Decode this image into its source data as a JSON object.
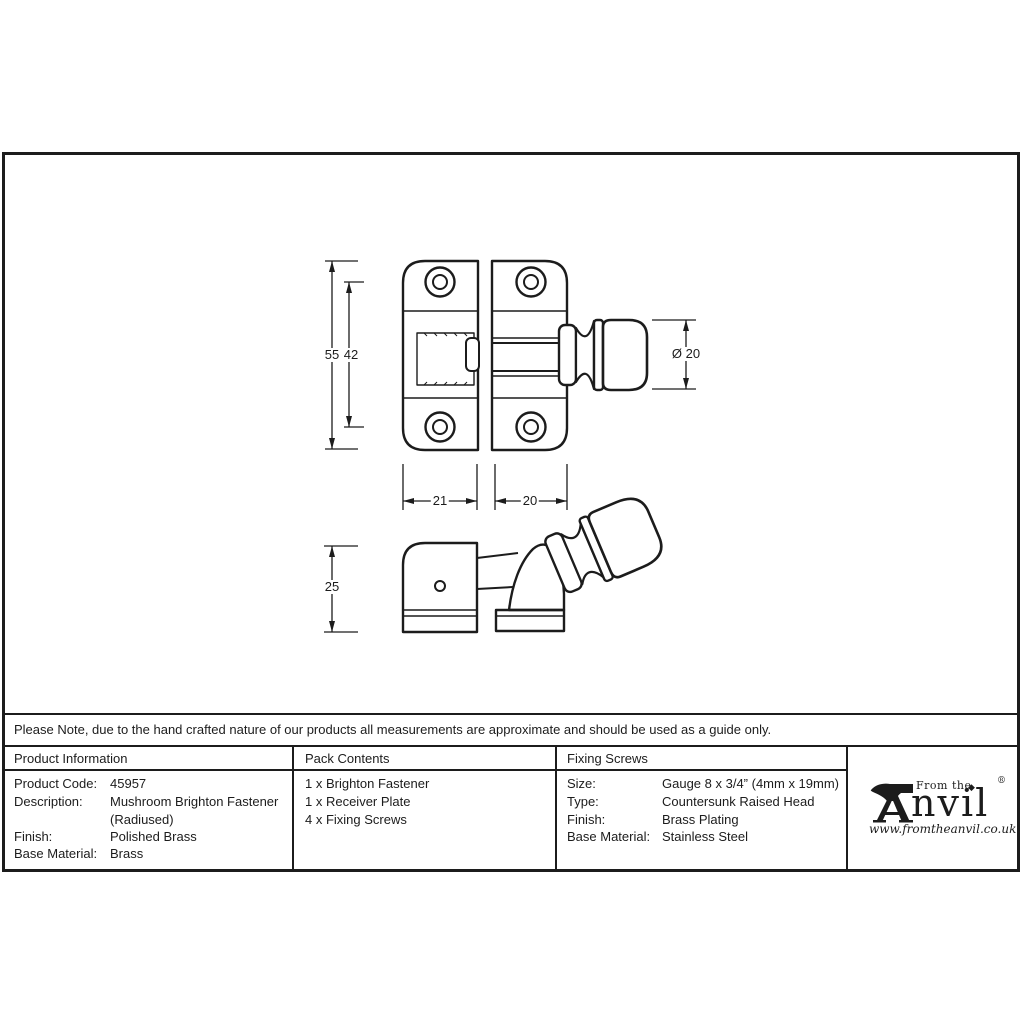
{
  "note": {
    "text": "Please Note, due to the hand crafted nature of our products all measurements are approximate and should be used as a guide only."
  },
  "table": {
    "product_information": {
      "header": "Product Information",
      "rows": [
        {
          "label": "Product Code:",
          "value": "45957"
        },
        {
          "label": "Description:",
          "value": "Mushroom Brighton Fastener"
        },
        {
          "label": "",
          "value": "(Radiused)"
        },
        {
          "label": "Finish:",
          "value": "Polished Brass"
        },
        {
          "label": "Base Material:",
          "value": "Brass"
        }
      ]
    },
    "pack_contents": {
      "header": "Pack Contents",
      "items": [
        "1 x Brighton Fastener",
        "1 x Receiver Plate",
        "4 x Fixing Screws"
      ]
    },
    "fixing_screws": {
      "header": "Fixing Screws",
      "rows": [
        {
          "label": "Size:",
          "value": "Gauge 8 x 3/4” (4mm x 19mm)"
        },
        {
          "label": "Type:",
          "value": "Countersunk Raised Head"
        },
        {
          "label": "Finish:",
          "value": "Brass Plating"
        },
        {
          "label": "Base Material:",
          "value": "Stainless Steel"
        }
      ]
    }
  },
  "drawing": {
    "dim_height_overall": "55",
    "dim_hole_spacing": "42",
    "dim_knob_diameter": "Ø 20",
    "dim_plate_width": "21",
    "dim_keep_width": "20",
    "dim_depth": "25"
  },
  "logo": {
    "prefix": "From the",
    "brand_rest": "nvil",
    "diamond": "◆",
    "registered": "®",
    "website": "www.fromtheanvil.co.uk"
  },
  "colors": {
    "ink": "#1c1c1c",
    "paper": "#ffffff"
  }
}
